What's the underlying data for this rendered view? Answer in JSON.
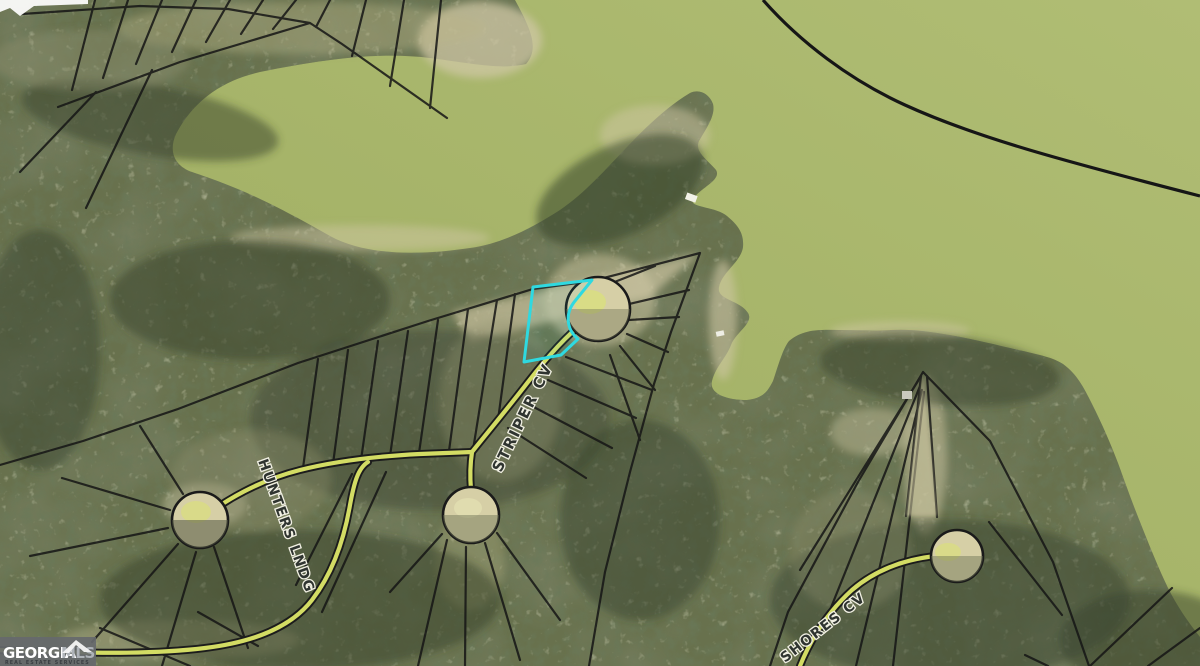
{
  "map": {
    "description": "Aerial plat map of lakefront subdivision lots with highlighted parcel",
    "labels": {
      "striper": "STRIPER CV",
      "hunters": "HUNTERS LNDG",
      "shores": "SHORES CV"
    },
    "highlight": {
      "name": "subject-lot-outline",
      "color": "#2fd9e0"
    },
    "watermark": {
      "brand_primary": "GEORGIA",
      "brand_secondary": "MLS",
      "tagline": "REAL ESTATE SERVICES"
    },
    "colors": {
      "water": "#a9b76c",
      "land": "#5f6848",
      "road": "#d3dc64",
      "parcel_line": "#151515",
      "culdesac": "#d4cca6"
    }
  }
}
